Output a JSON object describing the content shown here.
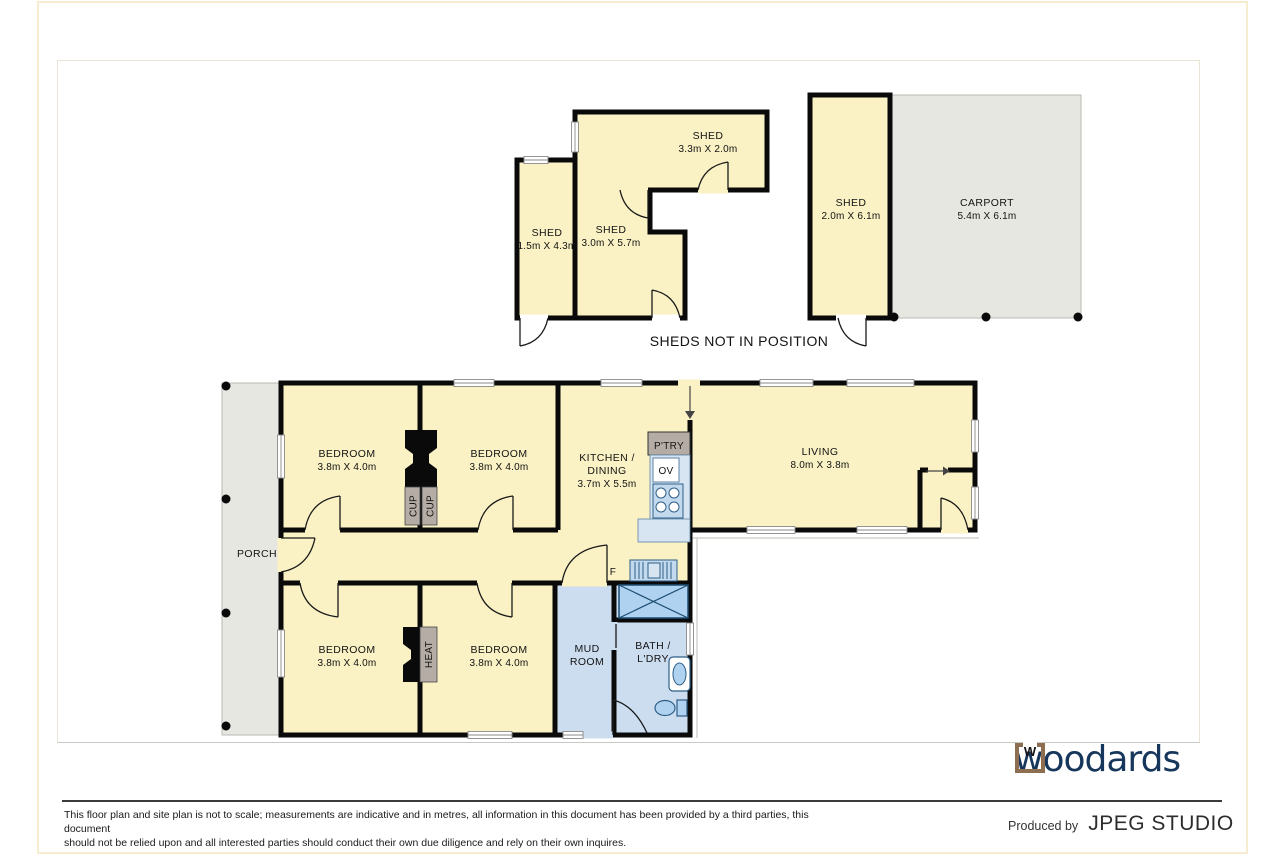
{
  "plan": {
    "sheds_note": "SHEDS NOT IN POSITION",
    "rooms": {
      "shed_top": {
        "name": "SHED",
        "dims": "3.3m X 2.0m"
      },
      "shed_narrow": {
        "name": "SHED",
        "dims": "1.5m X 4.3m"
      },
      "shed_center": {
        "name": "SHED",
        "dims": "3.0m X 5.7m"
      },
      "shed_carport": {
        "name": "SHED",
        "dims": "2.0m X 6.1m"
      },
      "carport": {
        "name": "CARPORT",
        "dims": "5.4m X 6.1m"
      },
      "bedroom": {
        "name": "BEDROOM",
        "dims": "3.8m X 4.0m"
      },
      "kitchen": {
        "name_line1": "KITCHEN /",
        "name_line2": "DINING",
        "dims": "3.7m X 5.5m"
      },
      "living": {
        "name": "LIVING",
        "dims": "8.0m X 3.8m"
      },
      "porch": {
        "name": "PORCH"
      },
      "mud": {
        "name_line1": "MUD",
        "name_line2": "ROOM"
      },
      "bath": {
        "name_line1": "BATH /",
        "name_line2": "L'DRY"
      }
    },
    "fixtures": {
      "pantry": "P'TRY",
      "oven": "OV",
      "cupboard": "CUP",
      "heater": "HEAT",
      "fridge": "F"
    }
  },
  "footer": {
    "brand": "woodards",
    "brand_mark": "W",
    "produced_by": "Produced by",
    "studio": "JPEG STUDIO",
    "disclaimer_line1": "This floor plan and site plan is not to scale; measurements are indicative and in metres, all information in this document has been provided by a third parties, this document",
    "disclaimer_line2": "should not be relied upon and all interested parties should conduct their own due diligence and rely on their own inquires."
  },
  "colors": {
    "room_fill": "#FAF2C5",
    "outdoor_fill": "#E7E7E2",
    "wet_room_fill": "#CDDDF0",
    "appliance_blue": "#AED2EF",
    "cabinet_tan": "#B5ADA5",
    "wall": "#0A0A0A",
    "brand_navy": "#17365C",
    "brand_brown": "#8D6E50"
  }
}
